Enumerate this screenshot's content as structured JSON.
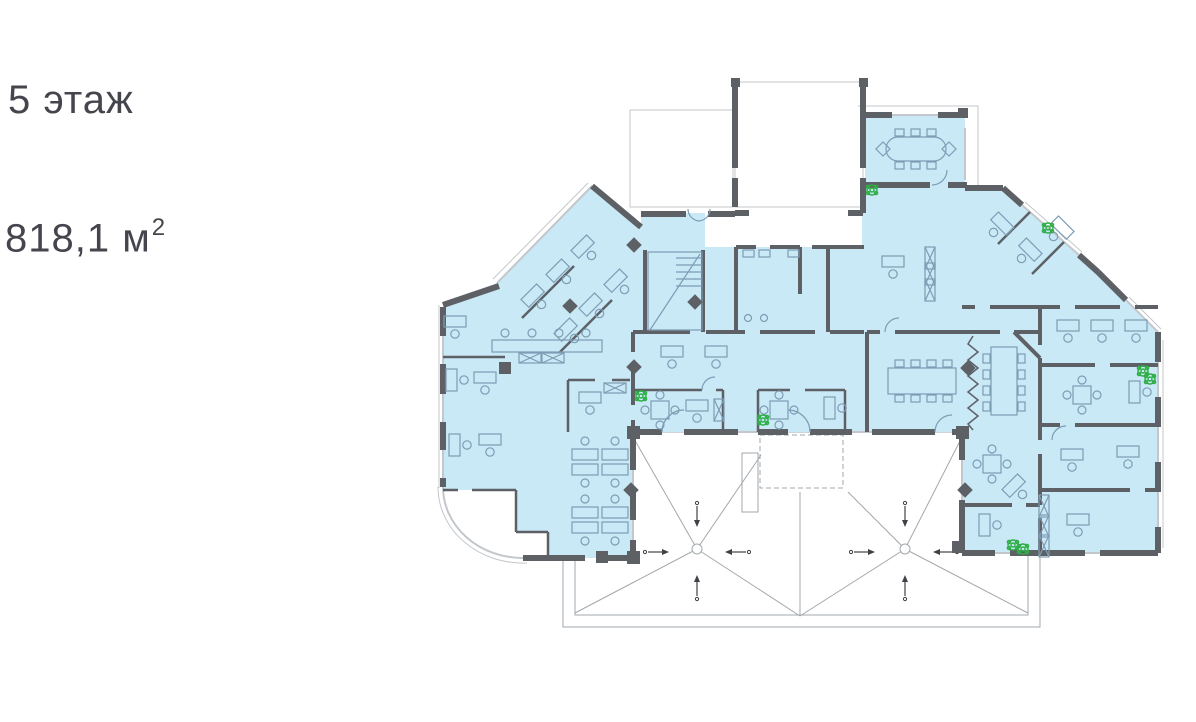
{
  "header": {
    "floor_label": "5 этаж",
    "area_value": "818,1 м",
    "area_superscript": "2"
  },
  "colors": {
    "background": "#ffffff",
    "text": "#45454d",
    "leasable_fill": "#c9e9f7",
    "wall_gray": "#5d6165",
    "furniture_line": "#7e9cb4",
    "window_line": "#c3c7cb",
    "roof_line": "#a3a8ac",
    "plant_green": "#2fae47",
    "arrow_dark": "#3f4347"
  }
}
